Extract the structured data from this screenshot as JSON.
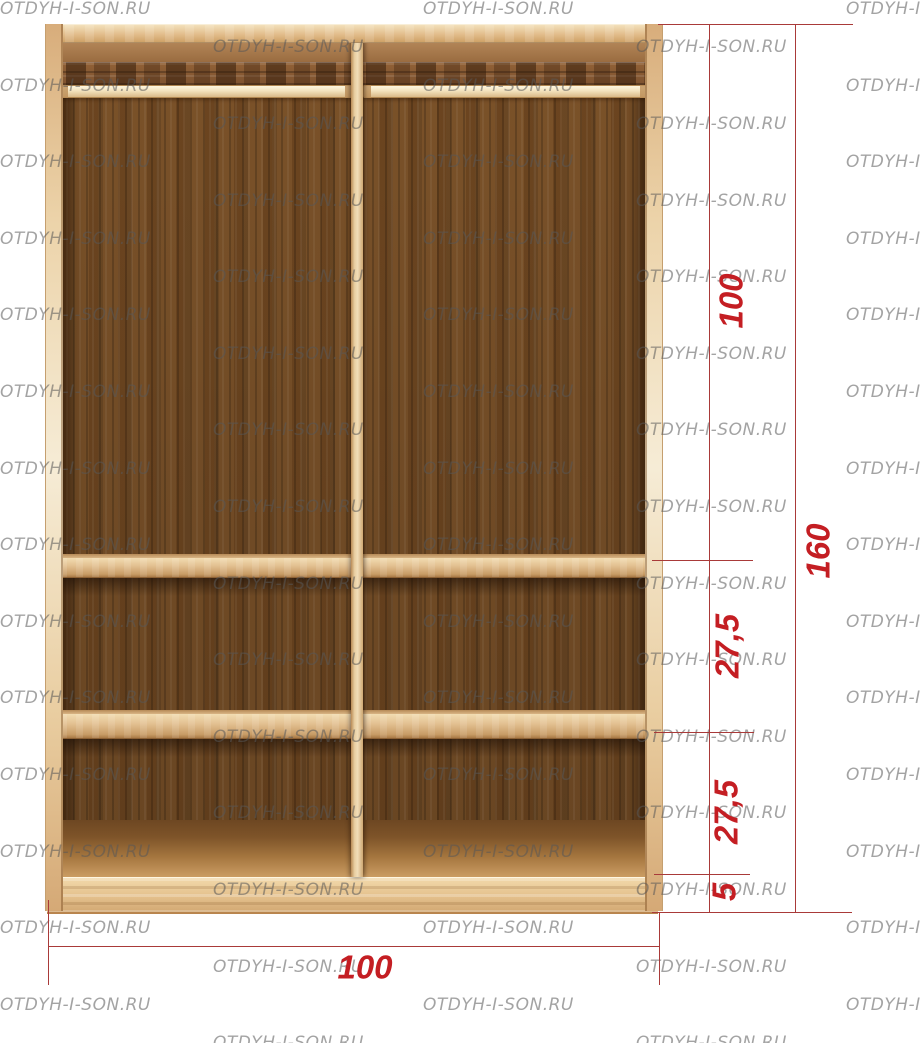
{
  "watermark": {
    "text": "OTDYH-I-SON.RU",
    "color": "#8c8c8c"
  },
  "diagram": {
    "type": "wardrobe-interior-elevation",
    "dimensions": {
      "upper_section_height": "100",
      "total_height": "160",
      "middle_section_height": "27,5",
      "lower_section_height": "27,5",
      "plinth_height": "5",
      "width": "100"
    },
    "colors": {
      "dimension_text": "#c41e23",
      "dimension_line": "#a93a39",
      "frame_wood_light": "#e6c393",
      "interior_dark_wood": "#714c28",
      "watermark_gray": "#8c8c8c"
    }
  }
}
